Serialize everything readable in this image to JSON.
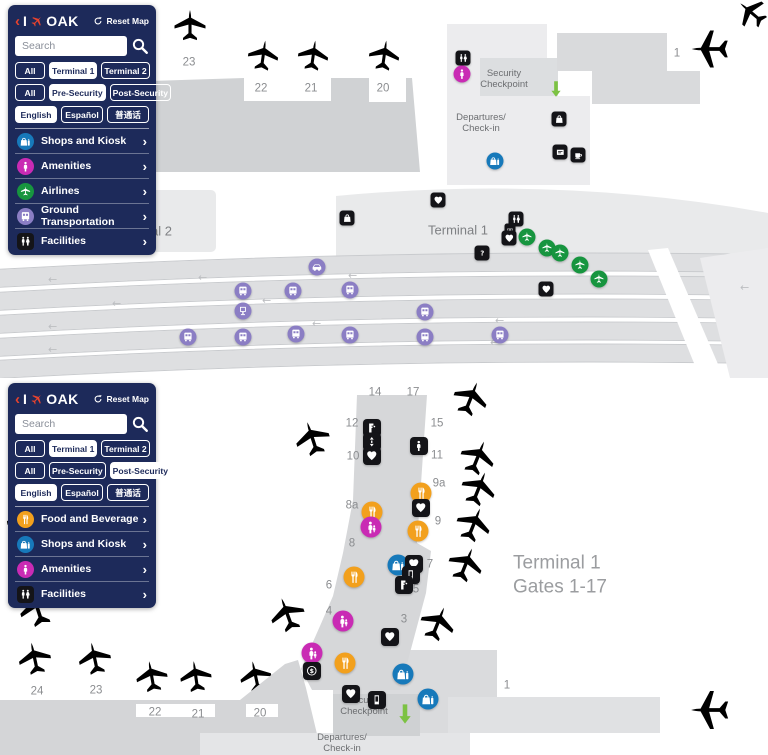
{
  "ui": {
    "chevron": "›"
  },
  "palette": {
    "sidebar_bg": "#1d2a5a",
    "accent_red": "#e8432e",
    "food": "#f2a01d",
    "shops": "#1779ba",
    "amenities": "#c92bb4",
    "airlines": "#17953f",
    "transport": "#8b7ec4",
    "facility": "#141418",
    "arrow": "#7cc243"
  },
  "panels": [
    {
      "name": "airport-overview",
      "sidebar": {
        "back": "‹",
        "brand_i": "I",
        "brand": "OAK",
        "reset": "Reset Map",
        "search_placeholder": "Search",
        "filters": [
          {
            "options": [
              {
                "label": "All"
              },
              {
                "label": "Terminal 1",
                "selected": true
              },
              {
                "label": "Terminal 2"
              }
            ]
          },
          {
            "options": [
              {
                "label": "All"
              },
              {
                "label": "Pre-Security",
                "selected": true
              },
              {
                "label": "Post-Security"
              }
            ]
          },
          {
            "options": [
              {
                "label": "English",
                "selected": true
              },
              {
                "label": "Español"
              },
              {
                "label": "普通话"
              }
            ]
          }
        ],
        "menu": [
          {
            "label": "Shops and Kiosk",
            "icon": "shops-icon",
            "type": "shops"
          },
          {
            "label": "Amenities",
            "icon": "amenities-icon",
            "type": "amenities"
          },
          {
            "label": "Airlines",
            "icon": "plane-icon",
            "type": "airlines"
          },
          {
            "label": "Ground Transportation",
            "icon": "bus-icon",
            "type": "transport"
          },
          {
            "label": "Facilities",
            "icon": "restroom-icon",
            "type": "facility"
          }
        ]
      },
      "labels": [
        {
          "text": "23",
          "x": 189,
          "y": 63,
          "cls": "gate"
        },
        {
          "text": "22",
          "x": 261,
          "y": 89,
          "cls": "gate"
        },
        {
          "text": "21",
          "x": 311,
          "y": 89,
          "cls": "gate"
        },
        {
          "text": "20",
          "x": 383,
          "y": 89,
          "cls": "gate"
        },
        {
          "text": "1",
          "x": 677,
          "y": 54,
          "cls": "gate"
        },
        {
          "text": "Security\nCheckpoint",
          "x": 504,
          "y": 80,
          "cls": "area-sm"
        },
        {
          "text": "Departures/\nCheck-in",
          "x": 481,
          "y": 124,
          "cls": "area-sm"
        },
        {
          "text": "Terminal 2",
          "x": 142,
          "y": 232,
          "cls": "area"
        },
        {
          "text": "Terminal 1",
          "x": 458,
          "y": 231,
          "cls": "area"
        }
      ],
      "markers": [
        {
          "icon": "restroom",
          "type": "facility",
          "x": 463,
          "y": 58
        },
        {
          "icon": "person",
          "type": "amenities",
          "x": 462,
          "y": 74
        },
        {
          "icon": "arrowdown",
          "type": "arrow",
          "x": 556,
          "y": 89
        },
        {
          "icon": "bag",
          "type": "facility",
          "x": 559,
          "y": 119
        },
        {
          "icon": "ticket",
          "type": "facility",
          "x": 560,
          "y": 152
        },
        {
          "icon": "coffee",
          "type": "facility",
          "x": 578,
          "y": 155
        },
        {
          "icon": "shops",
          "type": "shops",
          "x": 495,
          "y": 161
        },
        {
          "icon": "heart",
          "type": "facility",
          "x": 438,
          "y": 200
        },
        {
          "icon": "bag",
          "type": "facility",
          "x": 347,
          "y": 218
        },
        {
          "icon": "restroom",
          "type": "facility",
          "x": 516,
          "y": 219
        },
        {
          "icon": "s",
          "type": "facility",
          "small": true,
          "x": 510,
          "y": 229
        },
        {
          "icon": "heart",
          "type": "facility",
          "x": 509,
          "y": 238
        },
        {
          "icon": "plane",
          "type": "airlines",
          "x": 527,
          "y": 237
        },
        {
          "icon": "plane",
          "type": "airlines",
          "x": 547,
          "y": 248
        },
        {
          "icon": "plane",
          "type": "airlines",
          "x": 560,
          "y": 253
        },
        {
          "icon": "plane",
          "type": "airlines",
          "x": 580,
          "y": 265
        },
        {
          "icon": "plane",
          "type": "airlines",
          "x": 599,
          "y": 279
        },
        {
          "icon": "question",
          "type": "facility",
          "x": 482,
          "y": 253
        },
        {
          "icon": "heart",
          "type": "facility",
          "x": 546,
          "y": 289
        },
        {
          "icon": "car",
          "type": "transport",
          "x": 317,
          "y": 267
        },
        {
          "icon": "bus",
          "type": "transport",
          "x": 243,
          "y": 291
        },
        {
          "icon": "bus",
          "type": "transport",
          "x": 293,
          "y": 291
        },
        {
          "icon": "bus",
          "type": "transport",
          "x": 350,
          "y": 290
        },
        {
          "icon": "kiosk",
          "type": "transport",
          "x": 243,
          "y": 311
        },
        {
          "icon": "bus",
          "type": "transport",
          "x": 188,
          "y": 337
        },
        {
          "icon": "bus",
          "type": "transport",
          "x": 243,
          "y": 337
        },
        {
          "icon": "bus",
          "type": "transport",
          "x": 296,
          "y": 334
        },
        {
          "icon": "bus",
          "type": "transport",
          "x": 350,
          "y": 335
        },
        {
          "icon": "bus",
          "type": "transport",
          "x": 425,
          "y": 312
        },
        {
          "icon": "bus",
          "type": "transport",
          "x": 425,
          "y": 337
        },
        {
          "icon": "bus",
          "type": "transport",
          "x": 500,
          "y": 335
        }
      ]
    },
    {
      "name": "terminal1-gates",
      "sidebar": {
        "back": "‹",
        "brand_i": "I",
        "brand": "OAK",
        "reset": "Reset Map",
        "search_placeholder": "Search",
        "filters": [
          {
            "options": [
              {
                "label": "All"
              },
              {
                "label": "Terminal 1",
                "selected": true
              },
              {
                "label": "Terminal 2"
              }
            ]
          },
          {
            "options": [
              {
                "label": "All"
              },
              {
                "label": "Pre-Security"
              },
              {
                "label": "Post-Security",
                "selected": true
              }
            ]
          },
          {
            "options": [
              {
                "label": "English",
                "selected": true
              },
              {
                "label": "Español"
              },
              {
                "label": "普通话"
              }
            ]
          }
        ],
        "menu": [
          {
            "label": "Food and Beverage",
            "icon": "fork-icon",
            "type": "food"
          },
          {
            "label": "Shops and Kiosk",
            "icon": "shops-icon",
            "type": "shops"
          },
          {
            "label": "Amenities",
            "icon": "amenities-icon",
            "type": "amenities"
          },
          {
            "label": "Facilities",
            "icon": "restroom-icon",
            "type": "facility"
          }
        ]
      },
      "labels": [
        {
          "text": "14",
          "x": 375,
          "y": 15,
          "cls": "gate"
        },
        {
          "text": "17",
          "x": 413,
          "y": 15,
          "cls": "gate"
        },
        {
          "text": "12",
          "x": 352,
          "y": 46,
          "cls": "gate"
        },
        {
          "text": "15",
          "x": 437,
          "y": 46,
          "cls": "gate"
        },
        {
          "text": "10",
          "x": 353,
          "y": 79,
          "cls": "gate"
        },
        {
          "text": "11",
          "x": 437,
          "y": 78,
          "cls": "gate"
        },
        {
          "text": "9a",
          "x": 439,
          "y": 106,
          "cls": "gate"
        },
        {
          "text": "8a",
          "x": 352,
          "y": 128,
          "cls": "gate"
        },
        {
          "text": "9",
          "x": 438,
          "y": 144,
          "cls": "gate"
        },
        {
          "text": "8",
          "x": 352,
          "y": 166,
          "cls": "gate"
        },
        {
          "text": "7",
          "x": 430,
          "y": 187,
          "cls": "gate"
        },
        {
          "text": "6",
          "x": 329,
          "y": 208,
          "cls": "gate"
        },
        {
          "text": "5",
          "x": 416,
          "y": 212,
          "cls": "gate"
        },
        {
          "text": "4",
          "x": 329,
          "y": 234,
          "cls": "gate"
        },
        {
          "text": "3",
          "x": 404,
          "y": 242,
          "cls": "gate"
        },
        {
          "text": "1",
          "x": 507,
          "y": 308,
          "cls": "gate"
        },
        {
          "text": "24",
          "x": 37,
          "y": 314,
          "cls": "gate"
        },
        {
          "text": "23",
          "x": 96,
          "y": 313,
          "cls": "gate"
        },
        {
          "text": "22",
          "x": 155,
          "y": 335,
          "cls": "gate"
        },
        {
          "text": "21",
          "x": 198,
          "y": 337,
          "cls": "gate"
        },
        {
          "text": "20",
          "x": 260,
          "y": 336,
          "cls": "gate"
        },
        {
          "text": "Terminal 1\nGates 1-17",
          "x": 513,
          "y": 197,
          "cls": "big"
        },
        {
          "text": "Security\nCheckpoint",
          "x": 364,
          "y": 329,
          "cls": "area-sm"
        },
        {
          "text": "Departures/\nCheck-in",
          "x": 342,
          "y": 366,
          "cls": "area-sm"
        }
      ],
      "markers": [
        {
          "icon": "fountain",
          "type": "facility",
          "x": 372,
          "y": 50
        },
        {
          "icon": "elevator",
          "type": "facility",
          "x": 372,
          "y": 64
        },
        {
          "icon": "heart",
          "type": "facility",
          "x": 372,
          "y": 78
        },
        {
          "icon": "person",
          "type": "facility",
          "x": 419,
          "y": 68
        },
        {
          "icon": "fork",
          "type": "food",
          "x": 421,
          "y": 115
        },
        {
          "icon": "heart",
          "type": "facility",
          "x": 421,
          "y": 130
        },
        {
          "icon": "fork",
          "type": "food",
          "x": 372,
          "y": 134
        },
        {
          "icon": "mother",
          "type": "amenities",
          "x": 371,
          "y": 149
        },
        {
          "icon": "fork",
          "type": "food",
          "x": 418,
          "y": 153
        },
        {
          "icon": "shops",
          "type": "shops",
          "x": 398,
          "y": 187
        },
        {
          "icon": "heart",
          "type": "facility",
          "x": 414,
          "y": 186
        },
        {
          "icon": "scan",
          "type": "facility",
          "x": 411,
          "y": 197
        },
        {
          "icon": "fountain",
          "type": "facility",
          "x": 404,
          "y": 207
        },
        {
          "icon": "fork",
          "type": "food",
          "x": 354,
          "y": 199
        },
        {
          "icon": "mother",
          "type": "amenities",
          "x": 343,
          "y": 243
        },
        {
          "icon": "heart",
          "type": "facility",
          "x": 390,
          "y": 259
        },
        {
          "icon": "mother",
          "type": "amenities",
          "x": 312,
          "y": 275
        },
        {
          "icon": "dollar",
          "type": "facility",
          "x": 312,
          "y": 293
        },
        {
          "icon": "fork",
          "type": "food",
          "x": 345,
          "y": 285
        },
        {
          "icon": "shops",
          "type": "shops",
          "x": 403,
          "y": 296
        },
        {
          "icon": "heart",
          "type": "facility",
          "x": 351,
          "y": 316
        },
        {
          "icon": "scan",
          "type": "facility",
          "x": 377,
          "y": 322
        },
        {
          "icon": "shops",
          "type": "shops",
          "x": 428,
          "y": 321
        },
        {
          "icon": "arrowdown",
          "type": "arrow",
          "x": 405,
          "y": 336
        }
      ]
    }
  ]
}
